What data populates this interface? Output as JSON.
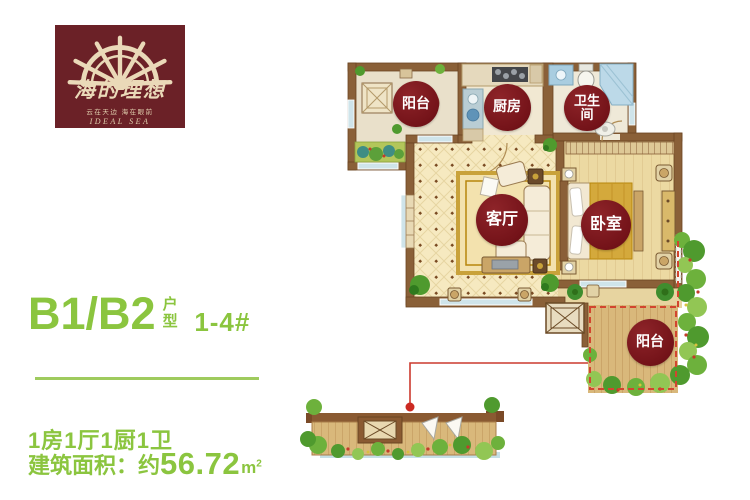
{
  "logo": {
    "brand_cn": "海的理想",
    "tagline": "云在天边 海在眼前",
    "brand_en": "IDEAL SEA",
    "bg_color": "#6b2127",
    "fg_color": "#ead9b8"
  },
  "unit": {
    "code": "B1/B2",
    "type_label": "户型",
    "buildings": "1-4#",
    "layout": "1房1厅1厨1卫",
    "area_prefix": "建筑面积：约",
    "area_value": "56.72",
    "area_unit": "m",
    "area_unit_sup": "2"
  },
  "plan": {
    "rooms": [
      {
        "label": "阳台",
        "x": 416,
        "y": 104,
        "d": 46,
        "fs": 14
      },
      {
        "label": "厨房",
        "x": 507,
        "y": 107,
        "d": 47,
        "fs": 14
      },
      {
        "label": "卫生间",
        "x": 587,
        "y": 108,
        "d": 46,
        "fs": 13,
        "wrap": true
      },
      {
        "label": "客厅",
        "x": 502,
        "y": 220,
        "d": 52,
        "fs": 16
      },
      {
        "label": "卧室",
        "x": 606,
        "y": 225,
        "d": 50,
        "fs": 16
      },
      {
        "label": "阳台",
        "x": 650,
        "y": 342,
        "d": 47,
        "fs": 14
      }
    ],
    "label_bg": "#741319",
    "label_fg": "#ffffff",
    "callout_color": "#cc2a22",
    "balcony_dash_color": "#d2452f"
  },
  "colors": {
    "accent_green": "#8bc53f",
    "wall_brown": "#8a6038",
    "deck_wood": "#d9b87b"
  }
}
